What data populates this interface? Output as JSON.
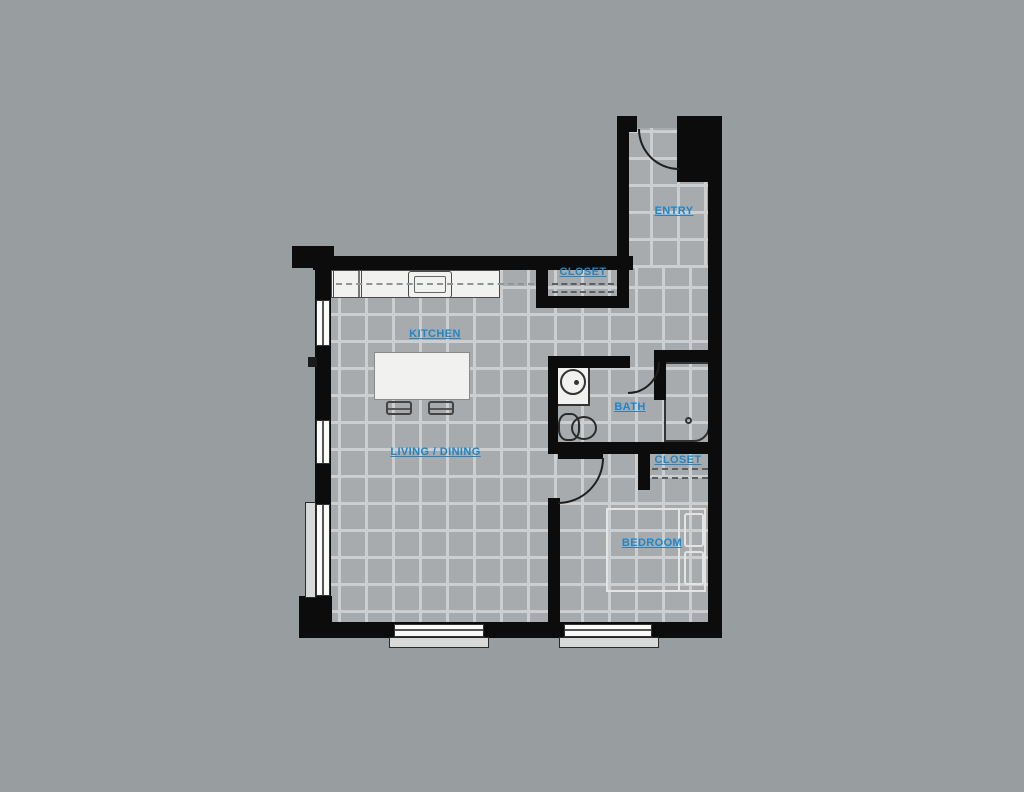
{
  "labels": {
    "entry": "ENTRY",
    "closet_upper": "CLOSET",
    "kitchen": "KITCHEN",
    "living_dining": "LIVING / DINING",
    "bath": "BATH",
    "closet_bedroom": "CLOSET",
    "bedroom": "BEDROOM"
  },
  "colors": {
    "bg": "#989da0",
    "wall": "#0c0c0c",
    "tile": "#a7abad",
    "grout": "#ccced0",
    "label": "#1e86c9",
    "fixture": "#f1f1ef",
    "sill": "#d8dad9"
  }
}
